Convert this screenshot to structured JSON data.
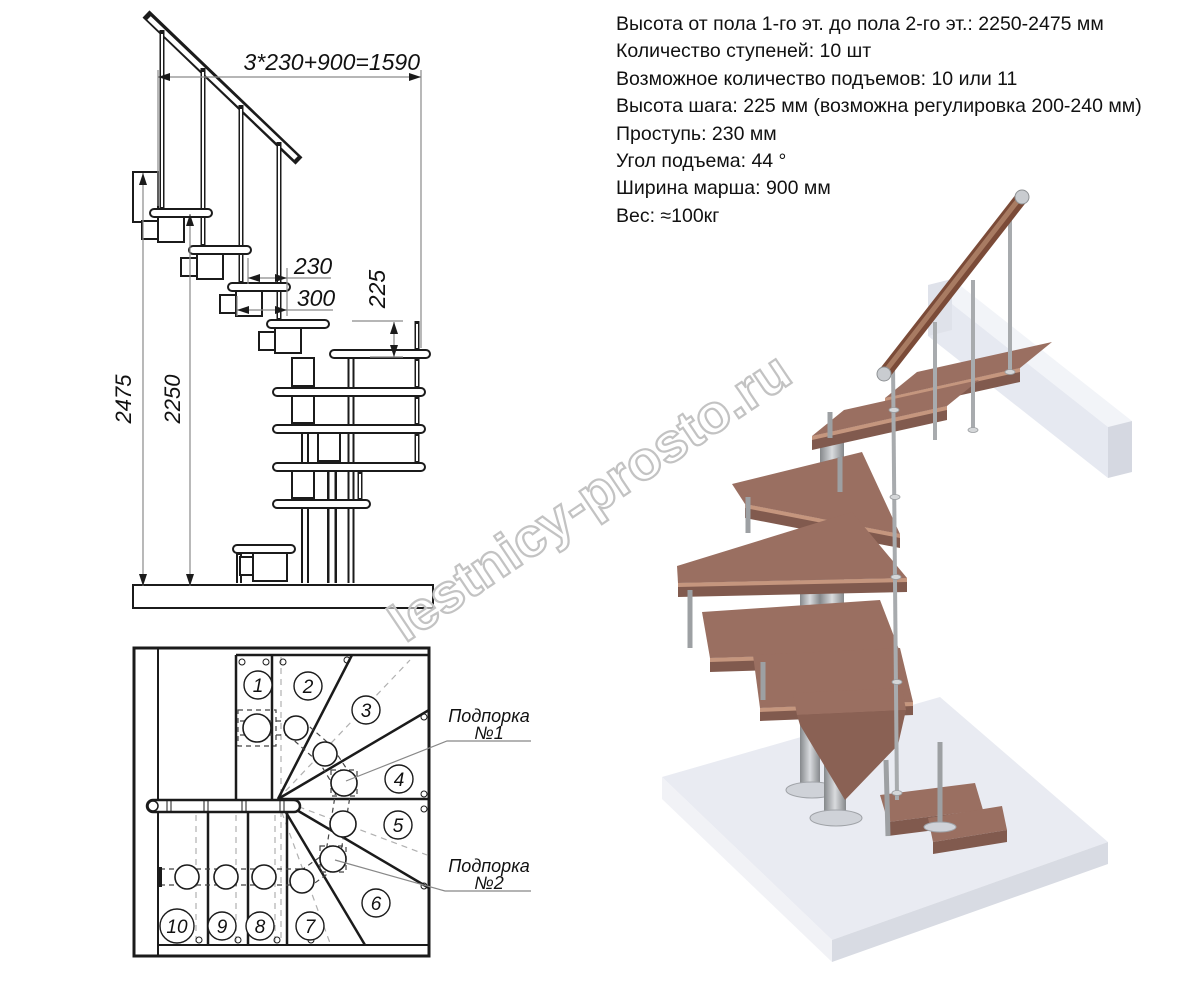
{
  "specs": {
    "lines": [
      "Высота от пола 1-го эт. до пола 2-го эт.: 2250-2475 мм",
      "Количество ступеней: 10 шт",
      "Возможное количество подъемов: 10 или 11",
      "Высота шага: 225 мм (возможна регулировка 200-240 мм)",
      "Проступь: 230 мм",
      "Угол подъема: 44 °",
      "Ширина марша: 900 мм",
      "Вес: ≈100кг"
    ]
  },
  "elevation": {
    "dims": {
      "total": "3*230+900=1590",
      "tread": "230",
      "module": "300",
      "riser": "225",
      "height_max": "2475",
      "height_min": "2250"
    }
  },
  "plan": {
    "steps": [
      "1",
      "2",
      "3",
      "4",
      "5",
      "6",
      "7",
      "8",
      "9",
      "10"
    ],
    "support1": {
      "line1": "Подпорка",
      "line2": "№1"
    },
    "support2": {
      "line1": "Подпорка",
      "line2": "№2"
    }
  },
  "watermark": {
    "text": "lestnicy-prosto.ru"
  },
  "colors": {
    "line": "#1b1b1b",
    "dim_line": "#8a8a8a",
    "wood": "#9a6f61",
    "wood_front": "#815a4e",
    "wood_edge": "#c5967e",
    "metal": "#9da0a3",
    "slab": "#e9ebf2",
    "watermark": "#c3c3c3"
  }
}
